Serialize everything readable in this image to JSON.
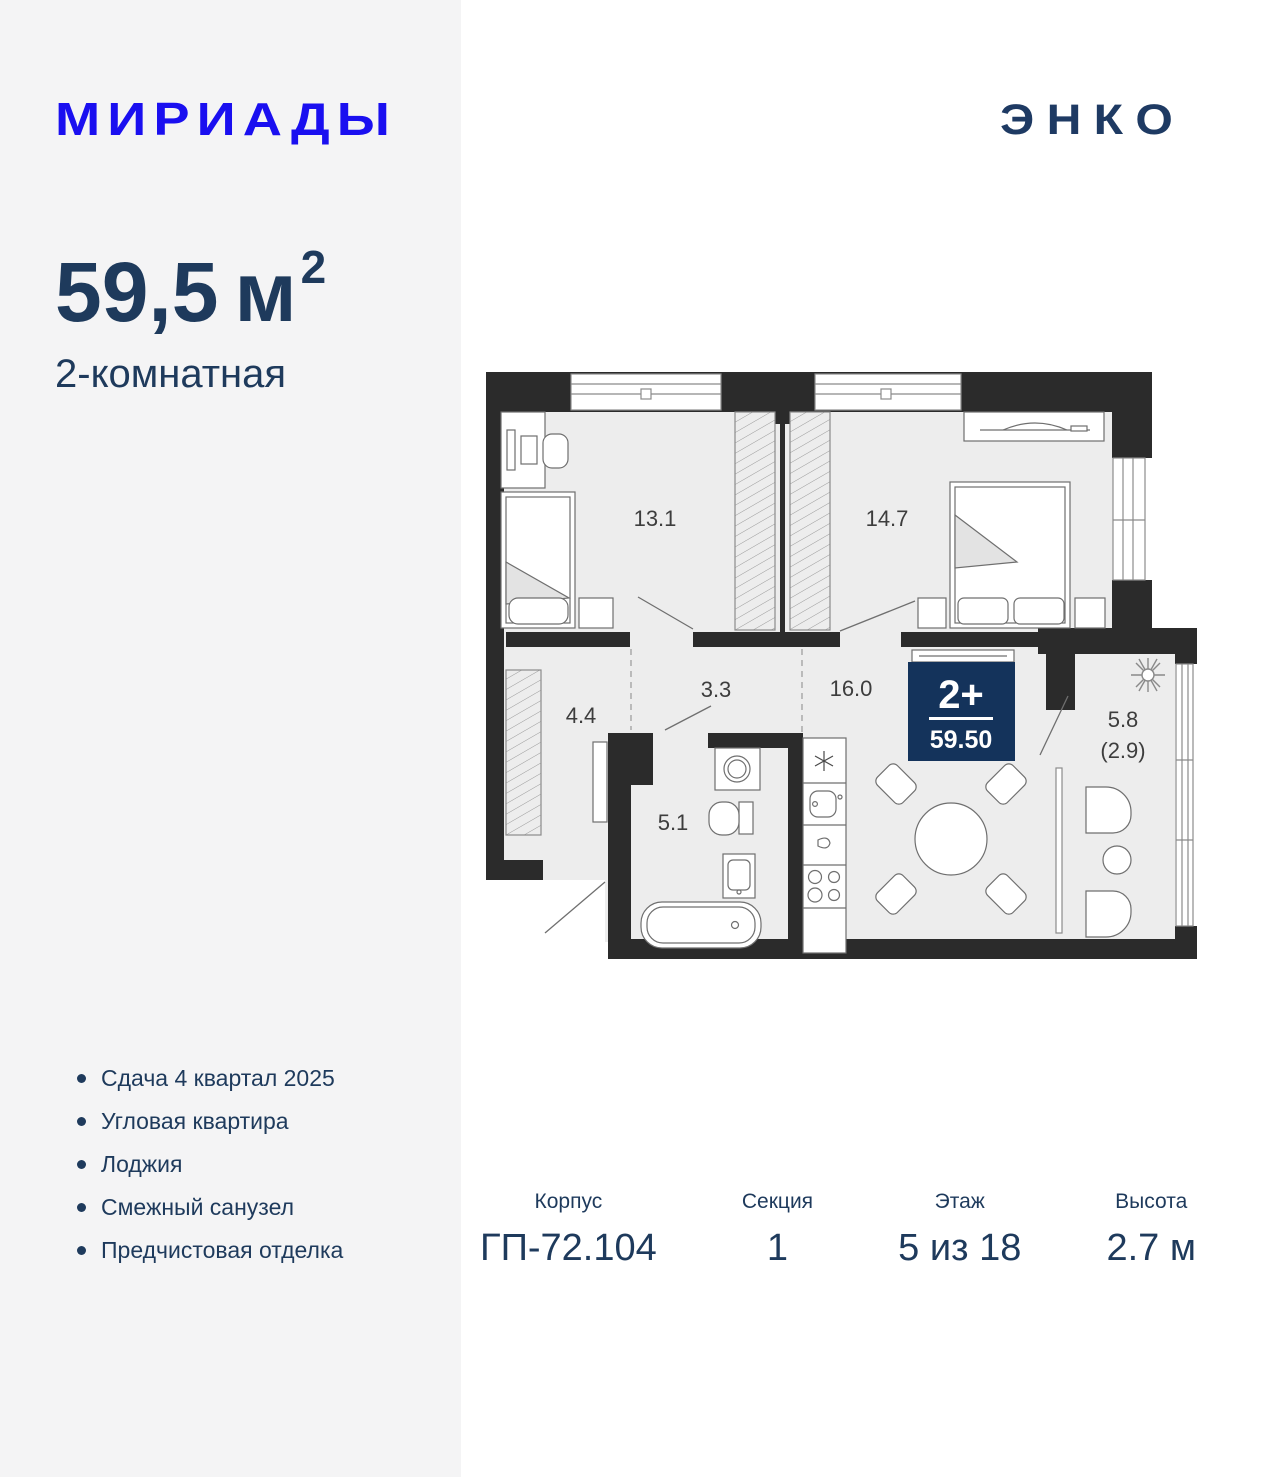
{
  "colors": {
    "page_background": "#ffffff",
    "left_panel": "#f4f4f5",
    "brand_blue": "#1a0ff0",
    "navy_text": "#1e3a5c",
    "badge_navy": "#14335b",
    "plan_walls": "#2b2b2b",
    "plan_room_fill": "#ededed"
  },
  "header": {
    "brand_logo": "МИРИАДЫ",
    "developer_logo": "ЭНКО"
  },
  "summary": {
    "area_value": "59,5",
    "area_unit": "м",
    "area_exponent": "2",
    "rooms_label": "2-комнатная"
  },
  "floorplan": {
    "badge": {
      "rooms": "2+",
      "area": "59.50"
    },
    "room_areas": {
      "bedroom1": "13.1",
      "bedroom2": "14.7",
      "hall": "3.3",
      "kitchen_living": "16.0",
      "entry_hall": "4.4",
      "bathroom": "5.1",
      "loggia": "5.8",
      "loggia_reduced": "(2.9)"
    },
    "icons": [
      "plant-icon",
      "fridge-asterisk-icon"
    ]
  },
  "features": {
    "items": [
      "Сдача 4 квартал 2025",
      "Угловая квартира",
      "Лоджия",
      "Смежный санузел",
      "Предчистовая отделка"
    ]
  },
  "details": {
    "columns": [
      {
        "label": "Корпус",
        "value": "ГП-72.104"
      },
      {
        "label": "Секция",
        "value": "1"
      },
      {
        "label": "Этаж",
        "value": "5 из 18"
      },
      {
        "label": "Высота",
        "value": "2.7 м"
      }
    ]
  }
}
